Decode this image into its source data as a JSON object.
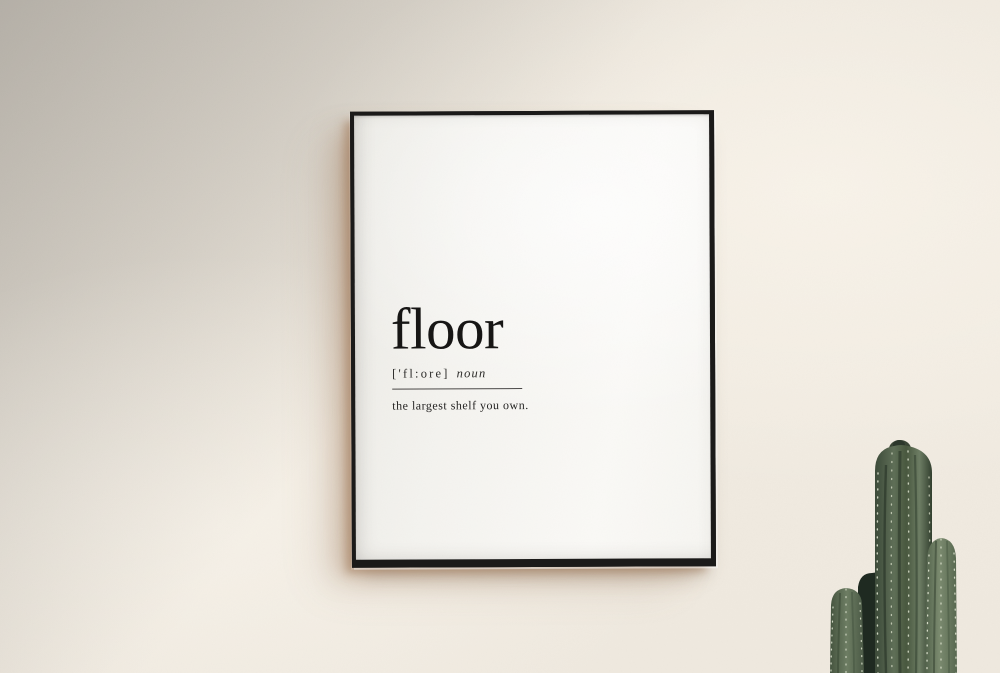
{
  "scene": {
    "description": "Framed typography definition poster hanging on a textured cream wall, soft shadow in the top-left corner, columnar cactus in the bottom-right",
    "wall_color": "#efe9df",
    "cast_shadow_color": "#a9805f"
  },
  "poster": {
    "word": "floor",
    "phonetic": "['fl:ore]",
    "part_of_speech": "noun",
    "definition": "the largest shelf you own.",
    "frame_color": "#1b1a19",
    "paper_color": "#f8f7f4",
    "text_color": "#171615"
  },
  "plant": {
    "type": "columnar cactus",
    "body_color": "#5a6a52",
    "shadow_color": "#222e23",
    "highlight_color": "#7d8d71",
    "spine_color": "#dde3cf"
  }
}
